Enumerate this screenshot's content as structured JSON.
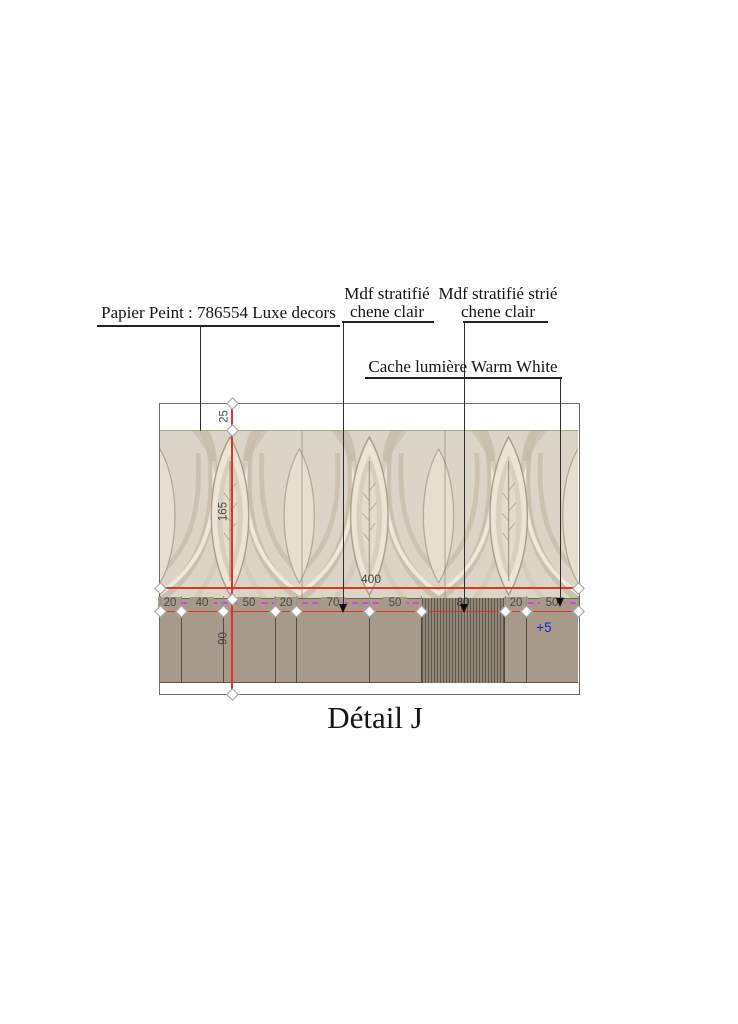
{
  "title": "Détail J",
  "annotations": {
    "papier_peint": "Papier Peint : 786554 Luxe decors",
    "mdf_clair_l1": "Mdf stratifié",
    "mdf_clair_l2": "chene clair",
    "mdf_strie_l1": "Mdf stratifié strié",
    "mdf_strie_l2": "chene clair",
    "cache_lumiere": "Cache lumière Warm White"
  },
  "dimensions": {
    "total_width": "400",
    "vertical": [
      "25",
      "165",
      "90"
    ],
    "segments": [
      "20",
      "40",
      "50",
      "20",
      "70",
      "50",
      "80",
      "20",
      "50"
    ],
    "offset_note": "+5"
  },
  "colors": {
    "dimension_red": "#e0342a",
    "dimension_magenta": "#c94fc9",
    "offset_blue": "#1e1ecf",
    "mdf_taupe": "#a89a8b",
    "strie_dark": "#5e564b",
    "wallpaper_base": "#dcd5c7"
  }
}
